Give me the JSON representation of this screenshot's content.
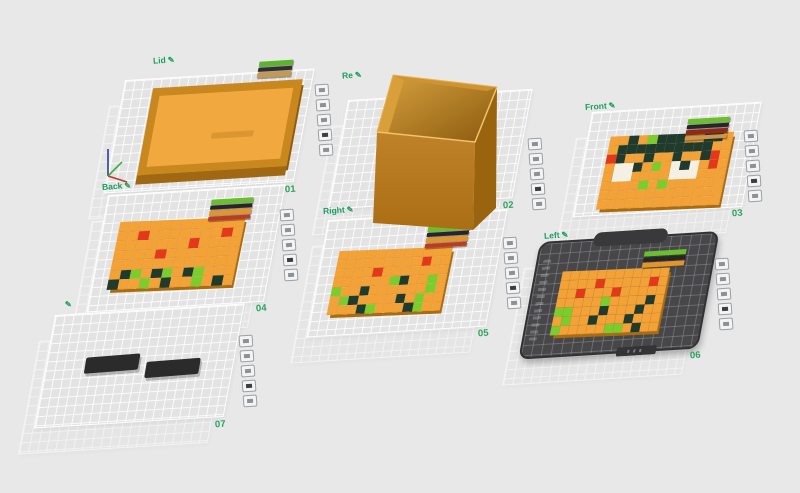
{
  "scene": {
    "background": "#e8e8e8"
  },
  "edit_icon": "✎",
  "colors": {
    "label_green": "#1a9f5c",
    "number_green": "#2aa25d",
    "plate_fill": "#e3e3e3",
    "plate_grid_line": "#ffffff",
    "dark_plate_fill": "#47474a",
    "panel_orange": "#f2a237",
    "panel_edge": "#a86d12",
    "box_front": "#b5771c",
    "box_right": "#9a640e",
    "box_rim": "#f2c26c"
  },
  "cell_colors": {
    "O": "#f2a237",
    "R": "#e2391b",
    "G": "#7ecb2d",
    "D": "#203b2c",
    "W": "#f4f1e4"
  },
  "axis_gizmo": {
    "x_color": "#c0392b",
    "y_color": "#3fae3f",
    "z_color": "#2c3e8f"
  },
  "toolbar_buttons": [
    {
      "name": "lock-plate"
    },
    {
      "name": "plate-settings"
    },
    {
      "name": "arrange-plate"
    },
    {
      "name": "rename-plate"
    },
    {
      "name": "delete-plate"
    }
  ],
  "plates": [
    {
      "id": "plate-1",
      "label": "Lid",
      "number": "01",
      "content": "tray",
      "swatches": [
        "#5cb32c",
        "#2f2f2f",
        "#c49a50"
      ]
    },
    {
      "id": "plate-2",
      "label": "Re",
      "number": "02",
      "content": "box"
    },
    {
      "id": "plate-3",
      "label": "Front",
      "number": "03",
      "content": "pattern",
      "swatches": [
        "#6abf2e",
        "#262626",
        "#8e2a1a",
        "#c9964e"
      ],
      "pattern": [
        "OODOGDDDOODDO",
        "ODDDDDDDDDDOO",
        "RDOODOODOODRO",
        "OWWDOGOWDWORO",
        "OWWOOOOWWWOOO",
        "OOOOGOGOOOOOO",
        "OOOOOOOOOOOOO",
        "OOOOOOOOOOOOO"
      ]
    },
    {
      "id": "plate-4",
      "label": "Back",
      "number": "04",
      "content": "pattern",
      "swatches": [
        "#6abf2e",
        "#262626",
        "#e0952d",
        "#c03a22"
      ],
      "pattern": [
        "OOOOOOOOOOOO",
        "OOROOOOOOORO",
        "OOOOOOOROOOO",
        "OOOOROOOOOOO",
        "OOOOOOOOOOOO",
        "ODGODGODGOOO",
        "DOOGODOOGODO"
      ]
    },
    {
      "id": "plate-5",
      "label": "Right",
      "number": "05",
      "content": "pattern",
      "swatches": [
        "#6abf2e",
        "#262626",
        "#e0952d",
        "#c03a22"
      ],
      "pattern": [
        "OOOOOOOOOOOO",
        "OOOOOOOOOROO",
        "OOOOROOOOOOO",
        "OOOOOOGDOOGO",
        "GOODOOOOOOGO",
        "OGDOOOODOGOO",
        "OOODGOOODGOO"
      ]
    },
    {
      "id": "plate-6",
      "label": "Left",
      "number": "06",
      "content": "pattern",
      "selected": true,
      "swatches": [
        "#6abf2e",
        "#262626",
        "#e0952d"
      ],
      "pattern": [
        "OOOOOOOOOOOO",
        "OOOOROOOOORO",
        "OOROOOROOOOO",
        "OOOOOGOOOODO",
        "GGOOODOOODOO",
        "OGOODOOODOOO",
        "GOOOOOGGODOO"
      ]
    },
    {
      "id": "plate-7",
      "label": "",
      "number": "07",
      "content": "parts"
    }
  ]
}
